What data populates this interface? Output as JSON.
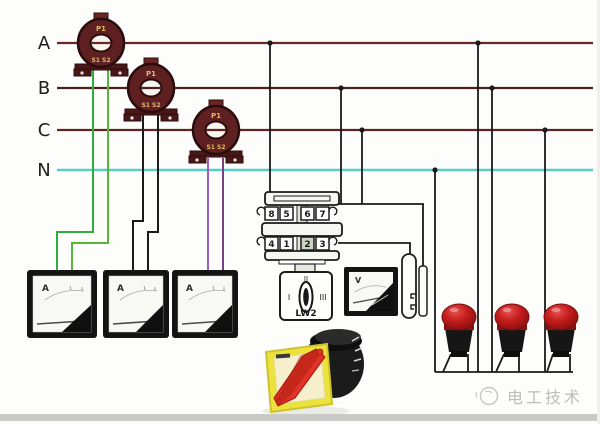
{
  "bus": {
    "labels": {
      "a": "A",
      "b": "B",
      "c": "C",
      "n": "N"
    },
    "colors": {
      "phase_a": "#6b2727",
      "phase_b": "#4a2121",
      "phase_c": "#5d2424",
      "neutral": "#57cec4"
    }
  },
  "current_transformers": {
    "primary_label": "P1",
    "secondary_label": "S1 S2",
    "body_color": "#5e2020"
  },
  "wire_colors": {
    "ct1_secondary_1": "#2fae3e",
    "ct1_secondary_2": "#57b53a",
    "ct2_secondary": "#1a1a1a",
    "ct3_secondary_1": "#9a5fb5",
    "ct3_secondary_2": "#7c3f86",
    "control": "#1a1a1a"
  },
  "ammeters": {
    "unit_label": "A"
  },
  "voltmeter": {
    "unit_label": "V"
  },
  "cam_switch": {
    "terminals_top": [
      "8",
      "5",
      "6",
      "7"
    ],
    "terminals_bottom": [
      "4",
      "1",
      "2",
      "3"
    ],
    "position_left": "I",
    "position_top": "II",
    "position_right": "III",
    "model_label": "LW2"
  },
  "indicator_lamps": {
    "lens_color": "#c41c1c",
    "base_color": "#161616"
  },
  "rotary_switch_photo": {
    "plate_color": "#ece23c",
    "handle_color": "#e03326"
  },
  "watermark": {
    "text": "电工技术",
    "color": "#bdbdbd"
  }
}
